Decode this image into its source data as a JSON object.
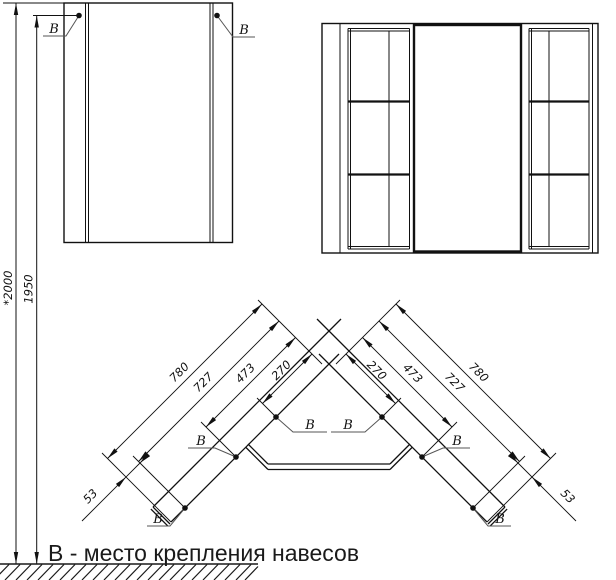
{
  "colors": {
    "ink": "#111111",
    "leader": "#555555",
    "background": "#ffffff"
  },
  "front_view": {
    "marker_left": "В",
    "marker_right": "В",
    "dim_total": "*2000",
    "dim_mount": "1950"
  },
  "plan_view": {
    "marker": "В",
    "left_dims": [
      "780",
      "727",
      "473",
      "270"
    ],
    "right_dims": [
      "270",
      "473",
      "727",
      "780"
    ],
    "end_dim_left": "53",
    "end_dim_right": "53"
  },
  "legend": {
    "text": "В - место крепления навесов"
  }
}
